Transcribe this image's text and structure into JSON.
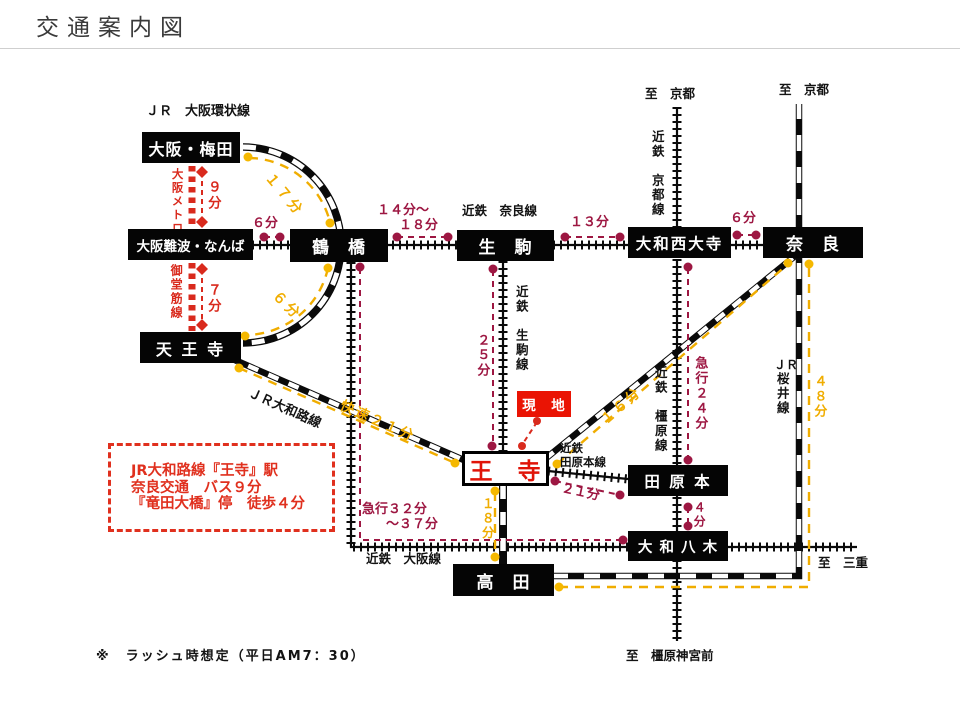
{
  "page": {
    "title": "交通案内図",
    "note": "※　ラッシュ時想定（平日AM7：30）"
  },
  "stations": {
    "umeda": "大阪・梅田",
    "namba": "大阪難波・なんば",
    "tsuruhashi": "鶴　橋",
    "ikoma": "生　駒",
    "saidaiji": "大和西大寺",
    "nara": "奈　良",
    "tennoji": "天 王 寺",
    "oji": "王　寺",
    "genchi": "現　地",
    "tawaramoto": "田 原 本",
    "yagi": "大 和 八 木",
    "takada": "高　田"
  },
  "lines": {
    "jr_loop": "ＪＲ　大阪環状線",
    "metro": "大阪メトロ",
    "midosuji": "御堂筋線",
    "kintetsu_nara": "近鉄　奈良線",
    "kintetsu_kyoto": "近鉄　京都線",
    "kintetsu_ikoma": "近鉄　生駒線",
    "kintetsu_kashihara": "近鉄　橿原線",
    "kintetsu_tawaramoto_l1": "近鉄",
    "kintetsu_tawaramoto_l2": "田原本線",
    "kintetsu_osaka": "近鉄　大阪線",
    "jr_yamatoji": "ＪＲ大和路線",
    "jr_sakurai_l1": "ＪＲ",
    "jr_sakurai_l2": "桜井線"
  },
  "times": {
    "umeda_namba": "９分",
    "namba_tennoji": "７分",
    "namba_tsuruhashi": "６分",
    "loop_umeda_tsuruhashi": "１７分",
    "loop_tsuruhashi_tennoji": "６分",
    "tsuruhashi_ikoma_l1": "１４分～",
    "tsuruhashi_ikoma_l2": "１８分",
    "ikoma_saidaiji": "１３分",
    "saidaiji_nara": "６分",
    "ikoma_oji": "２５分",
    "tennoji_oji_rapid": "快速２１分",
    "oji_nara": "１６分",
    "saidaiji_tawaramoto_exp": "急行２４分",
    "takada_nara_sakurai": "４８分",
    "oji_tawaramoto": "２１分",
    "tawaramoto_yagi": "４分",
    "tsuruhashi_yagi_exp_l1": "急行３２分",
    "tsuruhashi_yagi_exp_l2": "～３７分",
    "oji_takada": "１８分"
  },
  "destinations": {
    "kyoto_left": "至　京都",
    "kyoto_right": "至　京都",
    "mie": "至　三重",
    "kashihara_jingu": "至　橿原神宮前"
  },
  "info_box": {
    "line1": "JR大和路線『王寺』駅",
    "line2": "奈良交通　バス９分",
    "line3": "『竜田大橋』停　徒歩４分"
  },
  "colors": {
    "station_black": "#050505",
    "bright_red": "#d92a1d",
    "crimson": "#9d1742",
    "yellow": "#f0ad00",
    "genchi_red": "#ea1404",
    "oji_text_red": "#e01408"
  }
}
